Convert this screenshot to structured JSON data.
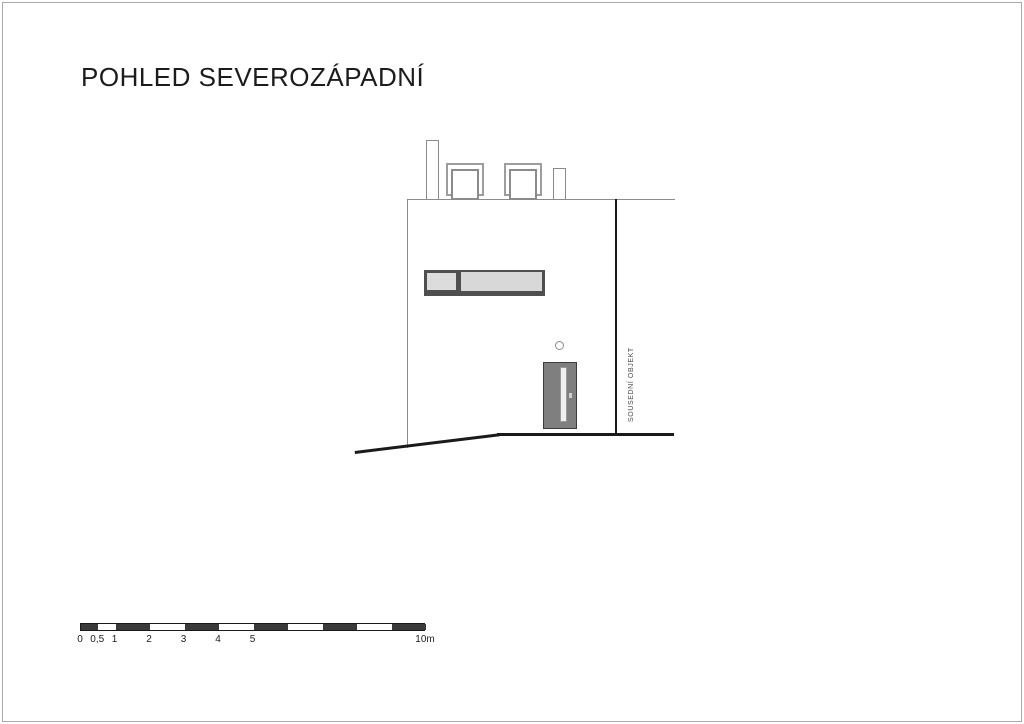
{
  "page": {
    "title": "POHLED SEVEROZÁPADNÍ",
    "background": "#ffffff",
    "border_color": "#a9a9a9"
  },
  "drawing": {
    "annotation_vertical": "SOUSEDNÍ OBJEKT",
    "colors": {
      "outline_gray": "#8b8b8b",
      "heavy_black": "#1a1a1a",
      "window_frame": "#4f4f4f",
      "window_glass": "#dcdcdc",
      "door_fill": "#7f7f7f",
      "door_border": "#3c3c3c",
      "door_glass_strip": "#f0f0f0"
    },
    "elements": [
      "roof-line",
      "left-wall-line",
      "neighbor-boundary-line",
      "chimney-left",
      "skylight-left",
      "skylight-right",
      "chimney-right",
      "strip-window",
      "wall-lamp",
      "entrance-door",
      "ground-line-horizontal",
      "ground-line-sloped"
    ]
  },
  "scalebar": {
    "px_per_m": 34.5,
    "total_m": 10,
    "unit": "m",
    "labels": [
      {
        "text": "0",
        "m": 0
      },
      {
        "text": "0,5",
        "m": 0.5
      },
      {
        "text": "1",
        "m": 1
      },
      {
        "text": "2",
        "m": 2
      },
      {
        "text": "3",
        "m": 3
      },
      {
        "text": "4",
        "m": 4
      },
      {
        "text": "5",
        "m": 5
      },
      {
        "text": "10m",
        "m": 10
      }
    ],
    "black_segments_m": [
      [
        0,
        0.5
      ],
      [
        1,
        2
      ],
      [
        3,
        4
      ],
      [
        5,
        6
      ],
      [
        7,
        8
      ],
      [
        9,
        10
      ]
    ]
  }
}
